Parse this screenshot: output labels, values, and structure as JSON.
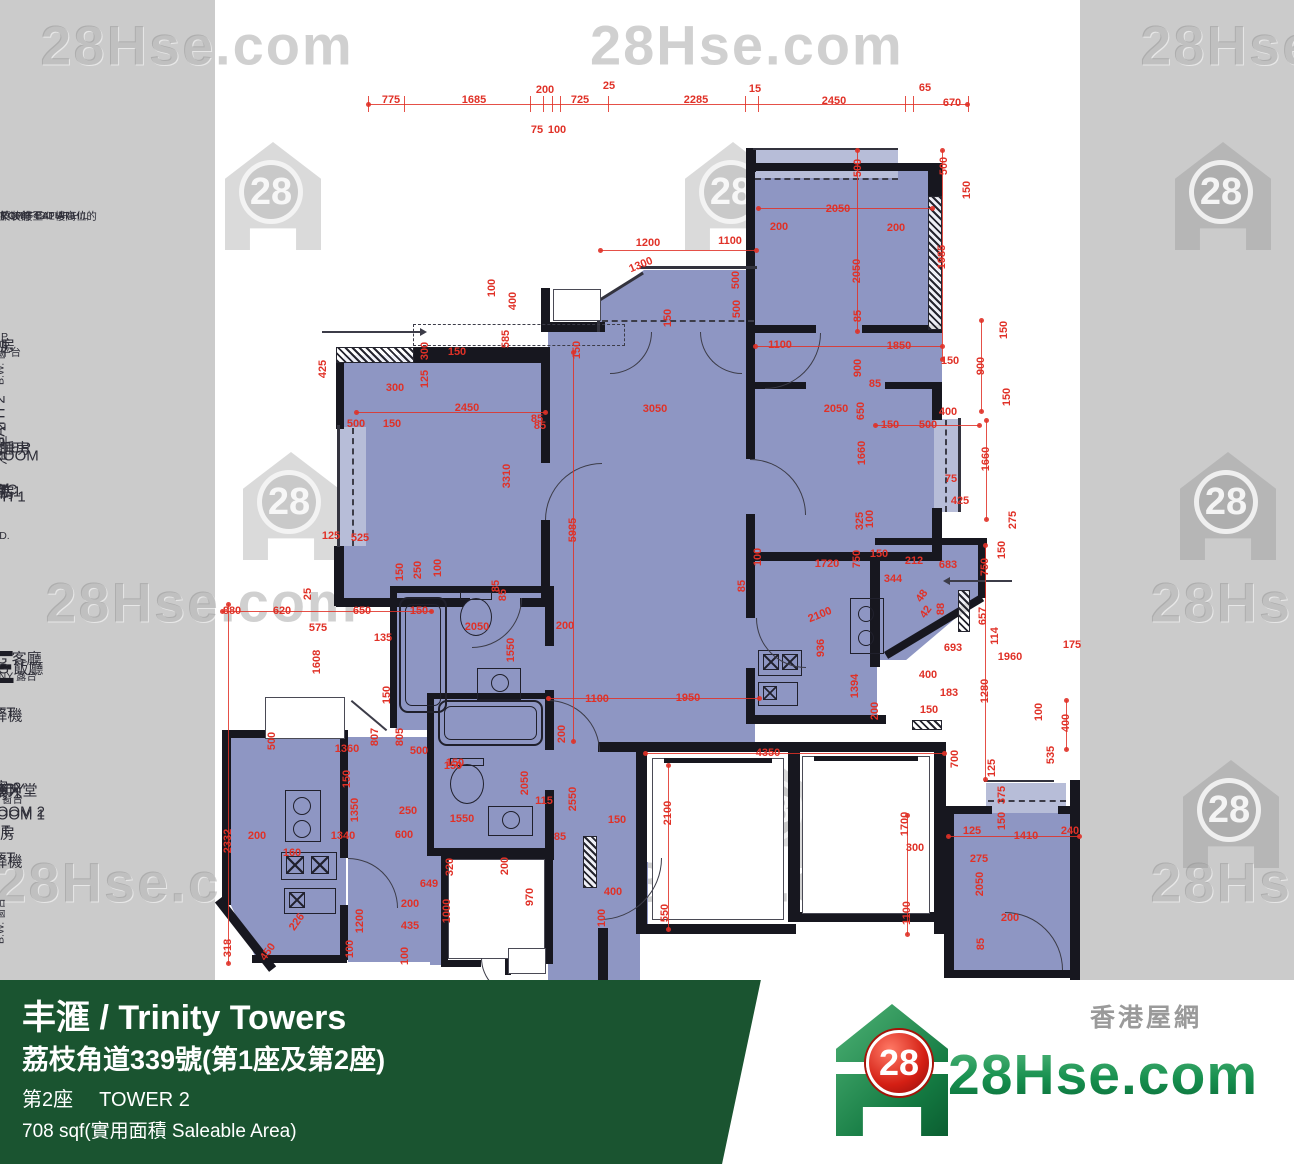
{
  "colors": {
    "background": "#cbcbcb",
    "paper": "#ffffff",
    "room_blue": "#8e96c3",
    "bay_window_blue": "#b7bdd8",
    "wall": "#17171f",
    "dimension_red": "#e03127",
    "banner_green": "#1a5430",
    "logo_green": "#1e9a55",
    "badge_red": "#d41f14"
  },
  "watermark": {
    "text": "28Hse.com",
    "badge": "28"
  },
  "logo": {
    "badge": "28",
    "text": "28Hse.com",
    "tagline": "香港屋網"
  },
  "banner": {
    "title": "丰滙 / Trinity Towers",
    "address": "荔枝角道339號(第1座及第2座)",
    "tower_zh": "第2座",
    "tower_en": "TOWER 2",
    "area": "708 sqf(實用面積 Saleable Area)"
  },
  "plan": {
    "unit": "E",
    "labels": [
      [
        "BEDROOM 1",
        815,
        241,
        "en"
      ],
      [
        "睡房 1",
        793,
        261,
        "en"
      ],
      [
        "B.W. 窗台",
        799,
        164,
        "sm"
      ],
      [
        "LIVING 客廳",
        658,
        375,
        "en"
      ],
      [
        "BALCONY 露台",
        676,
        297,
        "sm"
      ],
      [
        "MASTER",
        448,
        434,
        "en"
      ],
      [
        "BEDROOM",
        456,
        452,
        "en"
      ],
      [
        "主人睡房",
        448,
        471,
        "en"
      ],
      [
        "B.W. 窗台",
        362,
        466,
        "sm",
        "v"
      ],
      [
        "E",
        667,
        522,
        "unit"
      ],
      [
        "BEDROOM 2",
        812,
        486,
        "en"
      ],
      [
        "睡房 2",
        787,
        505,
        "en"
      ],
      [
        "B.W. 窗台",
        921,
        474,
        "sm",
        "v"
      ],
      [
        "U.P.",
        1029,
        577,
        "sm"
      ],
      [
        "工作平台",
        1041,
        592,
        "sm"
      ],
      [
        "U.P.",
        337,
        670,
        "sm"
      ],
      [
        "工作平台",
        352,
        685,
        "sm"
      ],
      [
        "BATH 2",
        421,
        656,
        "en",
        "v"
      ],
      [
        "浴室 2",
        444,
        658,
        "en",
        "v"
      ],
      [
        "BATH 1",
        497,
        725,
        "en"
      ],
      [
        "浴室 1",
        491,
        744,
        "en"
      ],
      [
        "DINING 飯廳",
        668,
        666,
        "en"
      ],
      [
        "KIT.",
        831,
        676,
        "en"
      ],
      [
        "廚房",
        833,
        694,
        "en"
      ],
      [
        "KIT.",
        345,
        864,
        "en"
      ],
      [
        "廚房",
        345,
        884,
        "en"
      ],
      [
        "ELEC.",
        490,
        894,
        "en"
      ],
      [
        "RM.",
        489,
        915,
        "en"
      ],
      [
        "電房",
        492,
        937,
        "en"
      ],
      [
        "LIFT",
        713,
        806,
        "en"
      ],
      [
        "升降機",
        715,
        825,
        "en"
      ],
      [
        "LIFT",
        858,
        809,
        "en"
      ],
      [
        "升降機",
        861,
        826,
        "en"
      ],
      [
        "LIFT",
        790,
        927,
        "en"
      ],
      [
        "LOBBY",
        789,
        947,
        "en"
      ],
      [
        "升降機大堂",
        790,
        967,
        "en"
      ],
      [
        "BEDROOM1",
        1031,
        860,
        "en"
      ],
      [
        "睡房 1",
        1013,
        881,
        "en"
      ],
      [
        "B.W. 窗台",
        1031,
        796,
        "sm"
      ],
      [
        "V.D.",
        536,
        964,
        "sm"
      ],
      [
        "RCH. FEATURE",
        216,
        300,
        "note",
        "l"
      ],
      [
        "T 27/F-42/F AT H/L",
        216,
        315,
        "note",
        "l"
      ],
      [
        "於27樓至42樓高位的",
        216,
        331,
        "note",
        "l"
      ],
      [
        "築裝飾",
        216,
        347,
        "note",
        "l"
      ]
    ],
    "dims": [
      [
        "775",
        391,
        100
      ],
      [
        "1685",
        474,
        100
      ],
      [
        "200",
        545,
        90
      ],
      [
        "75",
        537,
        130
      ],
      [
        "100",
        557,
        130
      ],
      [
        "725",
        580,
        100
      ],
      [
        "25",
        609,
        86
      ],
      [
        "2285",
        696,
        100
      ],
      [
        "15",
        755,
        89
      ],
      [
        "2450",
        834,
        101
      ],
      [
        "65",
        925,
        88
      ],
      [
        "670",
        952,
        103
      ],
      [
        "500",
        858,
        168,
        "v"
      ],
      [
        "500",
        944,
        166,
        "v"
      ],
      [
        "150",
        967,
        190,
        "v"
      ],
      [
        "2050",
        838,
        209
      ],
      [
        "200",
        779,
        227
      ],
      [
        "200",
        896,
        228
      ],
      [
        "2050",
        857,
        271,
        "v"
      ],
      [
        "1985",
        942,
        257,
        "v"
      ],
      [
        "85",
        858,
        316,
        "v"
      ],
      [
        "1100",
        780,
        345
      ],
      [
        "1850",
        899,
        346
      ],
      [
        "150",
        950,
        361
      ],
      [
        "900",
        981,
        366,
        "v"
      ],
      [
        "150",
        1004,
        330,
        "v"
      ],
      [
        "150",
        1007,
        397,
        "v"
      ],
      [
        "1200",
        648,
        243
      ],
      [
        "1100",
        730,
        241
      ],
      [
        "1300",
        641,
        265,
        "d"
      ],
      [
        "500",
        736,
        280,
        "v"
      ],
      [
        "500",
        737,
        309,
        "v"
      ],
      [
        "400",
        513,
        301,
        "v"
      ],
      [
        "100",
        492,
        288,
        "v"
      ],
      [
        "150",
        668,
        318,
        "v"
      ],
      [
        "585",
        506,
        339,
        "v"
      ],
      [
        "300",
        425,
        351,
        "v"
      ],
      [
        "150",
        457,
        352
      ],
      [
        "425",
        323,
        369,
        "v"
      ],
      [
        "125",
        425,
        379,
        "v"
      ],
      [
        "300",
        395,
        388
      ],
      [
        "2450",
        467,
        408
      ],
      [
        "85",
        537,
        419
      ],
      [
        "500",
        356,
        424
      ],
      [
        "150",
        392,
        424
      ],
      [
        "3310",
        507,
        476,
        "v"
      ],
      [
        "5985",
        573,
        530,
        "v"
      ],
      [
        "3050",
        655,
        409
      ],
      [
        "85",
        540,
        426
      ],
      [
        "150",
        577,
        350,
        "v"
      ],
      [
        "125",
        331,
        536
      ],
      [
        "525",
        360,
        538
      ],
      [
        "150",
        400,
        572,
        "v"
      ],
      [
        "250",
        418,
        570,
        "v"
      ],
      [
        "100",
        438,
        568,
        "v"
      ],
      [
        "85",
        496,
        586,
        "v"
      ],
      [
        "25",
        308,
        594,
        "v"
      ],
      [
        "880",
        232,
        611
      ],
      [
        "620",
        282,
        611
      ],
      [
        "650",
        362,
        611
      ],
      [
        "575",
        318,
        628
      ],
      [
        "135",
        383,
        638
      ],
      [
        "150",
        419,
        611
      ],
      [
        "1608",
        317,
        662,
        "v"
      ],
      [
        "150",
        387,
        695,
        "v"
      ],
      [
        "900",
        858,
        368,
        "v"
      ],
      [
        "85",
        875,
        384
      ],
      [
        "2050",
        836,
        409
      ],
      [
        "650",
        861,
        411,
        "v"
      ],
      [
        "1660",
        862,
        453,
        "v"
      ],
      [
        "1660",
        986,
        459,
        "v"
      ],
      [
        "400",
        948,
        412
      ],
      [
        "150",
        890,
        425
      ],
      [
        "500",
        928,
        425
      ],
      [
        "75",
        951,
        479
      ],
      [
        "425",
        960,
        501
      ],
      [
        "275",
        1013,
        520,
        "v"
      ],
      [
        "150",
        1002,
        550,
        "v"
      ],
      [
        "325",
        860,
        521,
        "v"
      ],
      [
        "100",
        870,
        519,
        "v"
      ],
      [
        "100",
        758,
        557,
        "v"
      ],
      [
        "85",
        742,
        586,
        "v"
      ],
      [
        "1720",
        827,
        564
      ],
      [
        "750",
        857,
        559,
        "v"
      ],
      [
        "150",
        879,
        554
      ],
      [
        "212",
        914,
        561
      ],
      [
        "683",
        948,
        565
      ],
      [
        "344",
        893,
        579
      ],
      [
        "48",
        922,
        596,
        "e"
      ],
      [
        "42",
        926,
        612,
        "e"
      ],
      [
        "88",
        941,
        609,
        "v"
      ],
      [
        "750",
        985,
        567,
        "v"
      ],
      [
        "657",
        983,
        616,
        "v"
      ],
      [
        "114",
        995,
        636,
        "v"
      ],
      [
        "693",
        953,
        648
      ],
      [
        "1960",
        1010,
        657
      ],
      [
        "175",
        1072,
        645
      ],
      [
        "400",
        928,
        675
      ],
      [
        "183",
        949,
        693
      ],
      [
        "150",
        929,
        710
      ],
      [
        "1280",
        985,
        691,
        "v"
      ],
      [
        "100",
        1039,
        712,
        "v"
      ],
      [
        "400",
        1066,
        723,
        "v"
      ],
      [
        "535",
        1051,
        755,
        "v"
      ],
      [
        "700",
        955,
        759,
        "v"
      ],
      [
        "125",
        992,
        768,
        "v"
      ],
      [
        "2100",
        820,
        615,
        "d"
      ],
      [
        "936",
        821,
        648,
        "v"
      ],
      [
        "1394",
        855,
        686,
        "v"
      ],
      [
        "200",
        875,
        711,
        "v"
      ],
      [
        "85",
        503,
        595,
        "v"
      ],
      [
        "200",
        565,
        626
      ],
      [
        "2050",
        477,
        627
      ],
      [
        "1550",
        511,
        650,
        "v"
      ],
      [
        "805",
        400,
        737,
        "v"
      ],
      [
        "807",
        375,
        737,
        "v"
      ],
      [
        "500",
        272,
        741,
        "v"
      ],
      [
        "1360",
        347,
        749
      ],
      [
        "500",
        419,
        751
      ],
      [
        "150",
        455,
        763
      ],
      [
        "150",
        347,
        779,
        "v"
      ],
      [
        "1350",
        355,
        810,
        "v"
      ],
      [
        "250",
        408,
        811
      ],
      [
        "600",
        404,
        835
      ],
      [
        "1340",
        343,
        836
      ],
      [
        "160",
        292,
        853
      ],
      [
        "200",
        257,
        836
      ],
      [
        "2332",
        228,
        841,
        "v"
      ],
      [
        "318",
        228,
        948,
        "v"
      ],
      [
        "450",
        268,
        952,
        "e"
      ],
      [
        "226",
        297,
        922,
        "e"
      ],
      [
        "1200",
        360,
        921,
        "v"
      ],
      [
        "100",
        350,
        949,
        "v"
      ],
      [
        "150",
        453,
        766
      ],
      [
        "2050",
        525,
        783,
        "v"
      ],
      [
        "115",
        544,
        801
      ],
      [
        "1550",
        462,
        819
      ],
      [
        "85",
        560,
        837
      ],
      [
        "200",
        562,
        734,
        "v"
      ],
      [
        "2550",
        573,
        799,
        "v"
      ],
      [
        "1100",
        597,
        699
      ],
      [
        "1950",
        688,
        698
      ],
      [
        "320",
        450,
        867,
        "v"
      ],
      [
        "200",
        505,
        866,
        "v"
      ],
      [
        "649",
        429,
        884
      ],
      [
        "970",
        530,
        897,
        "v"
      ],
      [
        "200",
        410,
        904
      ],
      [
        "435",
        410,
        926
      ],
      [
        "1000",
        447,
        911,
        "v"
      ],
      [
        "100",
        405,
        956,
        "v"
      ],
      [
        "4350",
        768,
        753
      ],
      [
        "2100",
        668,
        813,
        "v"
      ],
      [
        "150",
        617,
        820
      ],
      [
        "1700",
        905,
        824,
        "v"
      ],
      [
        "300",
        915,
        848
      ],
      [
        "1100",
        907,
        913,
        "v"
      ],
      [
        "550",
        665,
        913,
        "v"
      ],
      [
        "400",
        613,
        892
      ],
      [
        "100",
        602,
        918,
        "v"
      ],
      [
        "125",
        972,
        831
      ],
      [
        "1410",
        1026,
        836
      ],
      [
        "240",
        1070,
        831
      ],
      [
        "275",
        979,
        859
      ],
      [
        "2050",
        980,
        884,
        "v"
      ],
      [
        "200",
        1010,
        918
      ],
      [
        "85",
        981,
        944,
        "v"
      ],
      [
        "375",
        1002,
        795,
        "v"
      ],
      [
        "150",
        1002,
        821,
        "v"
      ]
    ]
  }
}
